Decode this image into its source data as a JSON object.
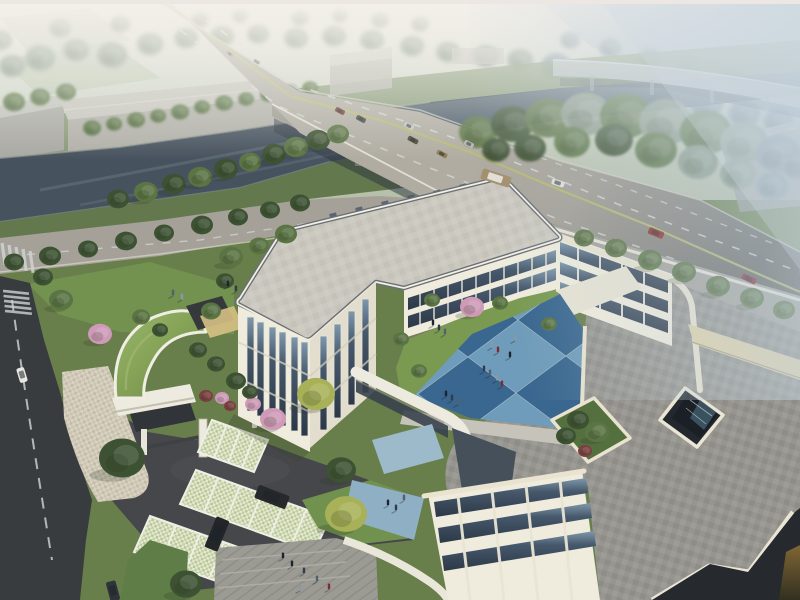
{
  "meta": {
    "description": "Aerial daytime architectural rendering: cream three-story school/office complex with blue checkerboard courtyard, roof terrace and atrium opening, grass-roof gate pavilion, grasscrete parking with SUVs, canal with road bridge, hazy elevated expressway, tree-lined arterial road and pedestrians",
    "visible_text": ""
  },
  "palette": {
    "sky_top": "#ece8e2",
    "sky_mid": "#c9d0c3",
    "haze_right": "#bccbd8",
    "field": "#b9c3a6",
    "river": "#46525e",
    "river_far": "#93a7b5",
    "road_light": "#b0aca2",
    "road_dark": "#545350",
    "marking_white": "#d6d9d6",
    "marking_yellow": "#b9bd6e",
    "street_asphalt": "#393c3f",
    "driveway": "#45474a",
    "wall_cream": "#efecdd",
    "wall_shade": "#e2ddcc",
    "trim_white": "#f2efe5",
    "roof_slab": "#cac8bf",
    "roof_band": "#686d74",
    "roof_paver": "#95948f",
    "roof_ne": "#a4a29b",
    "parapet_cream": "#e9e3cf",
    "band_tan": "#e0d3a9",
    "glass_dark": "#2e3a49",
    "glass_light": "#8099ad",
    "lawn": "#6f8e4e",
    "lawn_dark": "#67814a",
    "plaza": "#9b9a93",
    "apron": "#cfc8b8",
    "grasscrete": "#cdd6ae",
    "gate_roof": "#84a152",
    "terrace_green": "#55703f",
    "atrium_dark": "#23282e",
    "shadow_corner": "#26292d",
    "trees": {
      "dark": "#3d5233",
      "mid": "#5a7444",
      "light": "#7b9454",
      "yellow": "#a8b158",
      "pink": "#cf9ab8",
      "red": "#7a4040",
      "hazy": "#8a9a88",
      "hazyB": "#7f929b"
    },
    "courtyard_tiles": {
      "L": "#6f9cba",
      "D": "#3a678f",
      "M": "#5486ac",
      "N": "#2c5078",
      "G": "#9fb6c2"
    }
  },
  "courtyard": {
    "origin": [
      370,
      358
    ],
    "u": [
      50,
      -37
    ],
    "v": [
      48,
      36
    ],
    "grid": [
      [
        "L",
        "D",
        "L",
        "D",
        "L"
      ],
      [
        "D",
        "L",
        "D",
        "M",
        "D"
      ],
      [
        "L",
        "D",
        "L",
        "D",
        "N"
      ],
      [
        "G",
        "M",
        "D",
        "L",
        "D"
      ]
    ]
  },
  "scene": {
    "trees": {
      "far": [
        [
          12,
          66,
          13,
          "hazy"
        ],
        [
          40,
          58,
          15,
          "hazy"
        ],
        [
          76,
          50,
          13,
          "hazy"
        ],
        [
          112,
          55,
          15,
          "hazy"
        ],
        [
          150,
          44,
          13,
          "hazy"
        ],
        [
          186,
          38,
          12,
          "hazy"
        ],
        [
          222,
          36,
          12,
          "hazy"
        ],
        [
          258,
          34,
          11,
          "hazy"
        ],
        [
          296,
          38,
          12,
          "hazy"
        ],
        [
          334,
          36,
          12,
          "hazy"
        ],
        [
          372,
          40,
          12,
          "hazy"
        ],
        [
          412,
          46,
          12,
          "hazy"
        ],
        [
          448,
          52,
          12,
          "hazy"
        ],
        [
          486,
          56,
          13,
          "hazy"
        ],
        [
          520,
          60,
          13,
          "hazy"
        ],
        [
          300,
          18,
          9,
          "hazy"
        ],
        [
          340,
          16,
          8,
          "hazy"
        ],
        [
          380,
          20,
          9,
          "hazy"
        ],
        [
          420,
          24,
          9,
          "hazy"
        ],
        [
          200,
          20,
          9,
          "hazy"
        ],
        [
          240,
          16,
          8,
          "hazy"
        ],
        [
          120,
          24,
          10,
          "hazy"
        ],
        [
          60,
          28,
          11,
          "hazy"
        ],
        [
          0,
          40,
          12,
          "hazy"
        ],
        [
          556,
          66,
          15,
          "hazyB"
        ],
        [
          592,
          74,
          17,
          "hazyB"
        ],
        [
          630,
          84,
          18,
          "hazyB"
        ],
        [
          668,
          94,
          18,
          "hazyB"
        ],
        [
          706,
          104,
          17,
          "hazyB"
        ],
        [
          744,
          114,
          16,
          "hazyB"
        ],
        [
          778,
          122,
          15,
          "hazyB"
        ],
        [
          570,
          40,
          10,
          "hazyB"
        ],
        [
          610,
          48,
          11,
          "hazyB"
        ],
        [
          650,
          58,
          12,
          "hazyB"
        ],
        [
          690,
          66,
          12,
          "hazyB"
        ],
        [
          730,
          76,
          12,
          "hazyB"
        ],
        [
          770,
          86,
          11,
          "hazyB"
        ]
      ],
      "farbank": [
        [
          14,
          102,
          11,
          "mid"
        ],
        [
          40,
          97,
          10,
          "mid"
        ],
        [
          66,
          92,
          10,
          "mid"
        ],
        [
          92,
          128,
          9,
          "mid"
        ],
        [
          114,
          124,
          8,
          "mid"
        ],
        [
          136,
          120,
          9,
          "mid"
        ],
        [
          158,
          116,
          8,
          "mid"
        ],
        [
          180,
          112,
          9,
          "mid"
        ],
        [
          202,
          107,
          8,
          "mid"
        ],
        [
          224,
          103,
          9,
          "mid"
        ],
        [
          246,
          99,
          8,
          "mid"
        ],
        [
          268,
          95,
          8,
          "mid"
        ],
        [
          290,
          91,
          8,
          "mid"
        ],
        [
          310,
          88,
          8,
          "mid"
        ]
      ],
      "nearbank": [
        [
          118,
          199,
          11,
          "dark"
        ],
        [
          146,
          192,
          12,
          "mid"
        ],
        [
          174,
          184,
          12,
          "dark"
        ],
        [
          200,
          177,
          12,
          "mid"
        ],
        [
          226,
          169,
          12,
          "dark"
        ],
        [
          250,
          162,
          11,
          "mid"
        ],
        [
          274,
          154,
          12,
          "dark"
        ],
        [
          296,
          147,
          12,
          "mid"
        ],
        [
          318,
          140,
          12,
          "dark"
        ],
        [
          338,
          134,
          11,
          "mid"
        ]
      ],
      "eastmass": [
        [
          478,
          132,
          19,
          "mid"
        ],
        [
          512,
          124,
          21,
          "dark"
        ],
        [
          548,
          118,
          23,
          "mid"
        ],
        [
          586,
          114,
          25,
          "hazy"
        ],
        [
          626,
          116,
          26,
          "mid"
        ],
        [
          666,
          122,
          27,
          "hazy"
        ],
        [
          706,
          132,
          26,
          "mid"
        ],
        [
          744,
          142,
          24,
          "hazy"
        ],
        [
          778,
          154,
          22,
          "hazyB"
        ],
        [
          798,
          164,
          18,
          "hazyB"
        ],
        [
          530,
          148,
          16,
          "dark"
        ],
        [
          572,
          142,
          18,
          "mid"
        ],
        [
          614,
          140,
          19,
          "dark"
        ],
        [
          656,
          150,
          21,
          "mid"
        ],
        [
          698,
          162,
          20,
          "hazy"
        ],
        [
          738,
          174,
          18,
          "hazy"
        ],
        [
          772,
          186,
          16,
          "hazyB"
        ],
        [
          496,
          150,
          14,
          "dark"
        ]
      ],
      "roadsideL": [
        [
          14,
          262,
          10,
          "dark"
        ],
        [
          50,
          256,
          11,
          "dark"
        ],
        [
          88,
          249,
          10,
          "dark"
        ],
        [
          126,
          241,
          11,
          "dark"
        ],
        [
          164,
          233,
          10,
          "dark"
        ],
        [
          202,
          225,
          11,
          "dark"
        ],
        [
          238,
          217,
          10,
          "dark"
        ],
        [
          270,
          210,
          10,
          "dark"
        ],
        [
          300,
          203,
          10,
          "dark"
        ]
      ],
      "roadsideR": [
        [
          584,
          238,
          10,
          "mid"
        ],
        [
          616,
          248,
          11,
          "mid"
        ],
        [
          650,
          260,
          12,
          "mid"
        ],
        [
          684,
          272,
          12,
          "mid"
        ],
        [
          718,
          286,
          12,
          "mid"
        ],
        [
          752,
          298,
          12,
          "mid"
        ],
        [
          784,
          310,
          11,
          "mid"
        ]
      ],
      "site": [
        [
          100,
          334,
          12,
          "pink"
        ],
        [
          273,
          419,
          13,
          "pink"
        ],
        [
          472,
          307,
          12,
          "pink"
        ],
        [
          253,
          404,
          8,
          "pink"
        ],
        [
          122,
          458,
          23,
          "dark"
        ],
        [
          186,
          584,
          16,
          "dark"
        ],
        [
          346,
          514,
          21,
          "yellow"
        ],
        [
          316,
          394,
          19,
          "yellow"
        ],
        [
          341,
          470,
          15,
          "dark"
        ],
        [
          231,
          257,
          12,
          "mid"
        ],
        [
          259,
          246,
          10,
          "mid"
        ],
        [
          286,
          234,
          11,
          "mid"
        ],
        [
          225,
          281,
          9,
          "dark"
        ],
        [
          211,
          311,
          10,
          "mid"
        ],
        [
          61,
          300,
          12,
          "mid"
        ],
        [
          43,
          277,
          10,
          "dark"
        ],
        [
          141,
          317,
          9,
          "mid"
        ],
        [
          160,
          330,
          8,
          "dark"
        ],
        [
          500,
          303,
          8,
          "mid"
        ],
        [
          549,
          324,
          8,
          "mid"
        ],
        [
          401,
          339,
          8,
          "mid"
        ],
        [
          419,
          371,
          8,
          "mid"
        ],
        [
          432,
          300,
          8,
          "mid"
        ],
        [
          198,
          350,
          9,
          "dark"
        ],
        [
          216,
          364,
          9,
          "dark"
        ],
        [
          236,
          381,
          10,
          "dark"
        ],
        [
          250,
          392,
          8,
          "dark"
        ],
        [
          206,
          396,
          7,
          "red"
        ],
        [
          222,
          398,
          7,
          "pink"
        ],
        [
          230,
          406,
          6,
          "red"
        ]
      ],
      "terrace": [
        [
          578,
          420,
          11,
          "dark"
        ],
        [
          597,
          432,
          12,
          "mid"
        ],
        [
          566,
          436,
          10,
          "dark"
        ],
        [
          585,
          451,
          7,
          "red"
        ]
      ]
    },
    "people": {
      "courtyard": [
        [
          433,
          325
        ],
        [
          439,
          330
        ],
        [
          445,
          334
        ],
        [
          492,
          347
        ],
        [
          498,
          352
        ],
        [
          510,
          357
        ],
        [
          484,
          371
        ],
        [
          490,
          375
        ],
        [
          497,
          380
        ],
        [
          502,
          386
        ],
        [
          446,
          396
        ],
        [
          452,
          400
        ],
        [
          458,
          404
        ],
        [
          515,
          340
        ]
      ],
      "plaza": [
        [
          292,
          566
        ],
        [
          304,
          573
        ],
        [
          317,
          581
        ],
        [
          300,
          590
        ],
        [
          329,
          589
        ],
        [
          283,
          558
        ]
      ],
      "lawn": [
        [
          228,
          286
        ],
        [
          236,
          291
        ],
        [
          173,
          295
        ],
        [
          182,
          299
        ]
      ],
      "walkway": [
        [
          388,
          505
        ],
        [
          396,
          510
        ],
        [
          404,
          500
        ]
      ]
    },
    "vehicles": [
      {
        "name": "car-distant-1",
        "x": 230,
        "y": 54,
        "w": 8,
        "h": 4,
        "rot": 32,
        "color": "#9c9c96"
      },
      {
        "name": "bus-distant",
        "x": 257,
        "y": 62,
        "w": 13,
        "h": 5,
        "rot": 32,
        "color": "#d8d8d2"
      },
      {
        "name": "car-bridge-1",
        "x": 340,
        "y": 111,
        "w": 10,
        "h": 5,
        "rot": 28,
        "color": "#6e3b34"
      },
      {
        "name": "car-bridge-2",
        "x": 361,
        "y": 119,
        "w": 10,
        "h": 5,
        "rot": 28,
        "color": "#43474c"
      },
      {
        "name": "car-bridge-3",
        "x": 409,
        "y": 126,
        "w": 10,
        "h": 5,
        "rot": 28,
        "color": "#c6c6c2"
      },
      {
        "name": "car-bridge-4",
        "x": 413,
        "y": 140,
        "w": 11,
        "h": 5,
        "rot": 28,
        "color": "#4e4639"
      },
      {
        "name": "car-bridge-5",
        "x": 442,
        "y": 154,
        "w": 11,
        "h": 5,
        "rot": 28,
        "color": "#8e7c58"
      },
      {
        "name": "car-bridge-6",
        "x": 469,
        "y": 144,
        "w": 10,
        "h": 5,
        "rot": 28,
        "color": "#b4b4b0"
      },
      {
        "name": "bus-main",
        "x": 496,
        "y": 178,
        "w": 30,
        "h": 11,
        "rot": 18,
        "color": "#a3906f",
        "top": "#e8e4da"
      },
      {
        "name": "pickup-white",
        "x": 558,
        "y": 183,
        "w": 13,
        "h": 6,
        "rot": 18,
        "color": "#e0e0da"
      },
      {
        "name": "suv-red",
        "x": 656,
        "y": 233,
        "w": 16,
        "h": 7,
        "rot": 22,
        "color": "#8d2a26"
      },
      {
        "name": "car-red",
        "x": 749,
        "y": 279,
        "w": 15,
        "h": 6,
        "rot": 25,
        "color": "#7e2326"
      },
      {
        "name": "van-street",
        "x": 22,
        "y": 375,
        "w": 15,
        "h": 8,
        "rot": 73,
        "color": "#e6e7e2"
      },
      {
        "name": "car-street",
        "x": 113,
        "y": 591,
        "w": 20,
        "h": 10,
        "rot": 75,
        "color": "#303438"
      },
      {
        "name": "suv-parked-1",
        "x": 272,
        "y": 497,
        "w": 33,
        "h": 14,
        "rot": 21,
        "color": "#27292c"
      },
      {
        "name": "suv-parked-2",
        "x": 217,
        "y": 534,
        "w": 33,
        "h": 14,
        "rot": 112,
        "color": "#232528"
      }
    ]
  }
}
